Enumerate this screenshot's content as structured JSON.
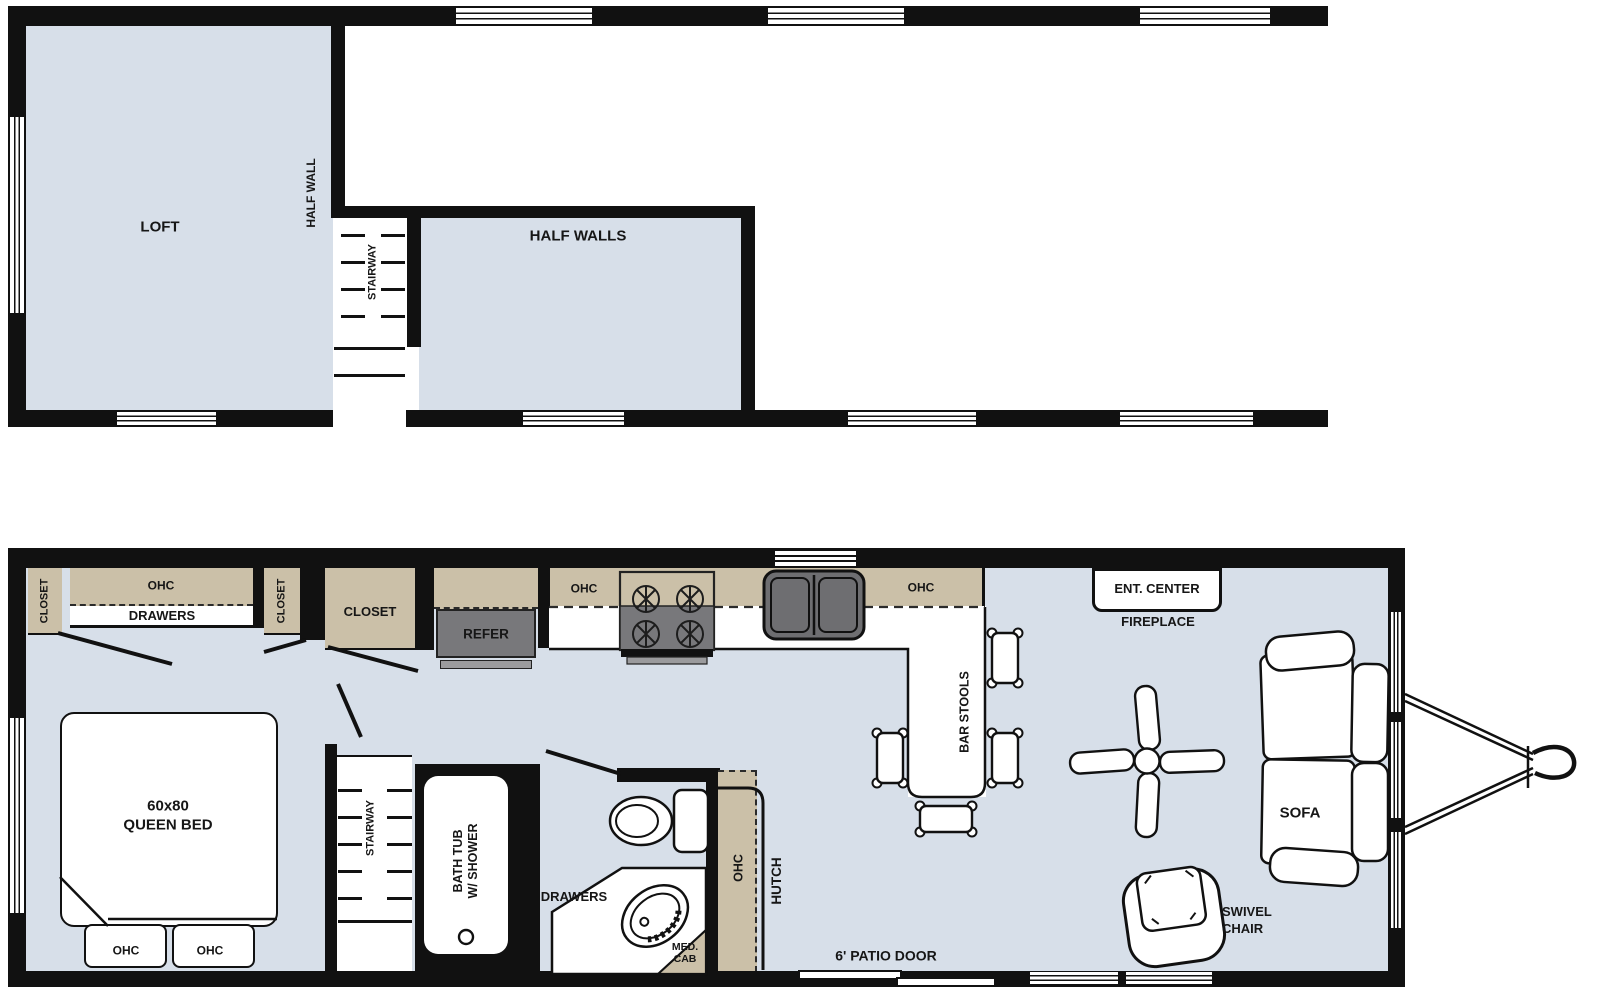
{
  "colors": {
    "wall": "#111111",
    "floor_blue": "#d7dfe9",
    "cabinet_tan": "#cbc0a8",
    "appliance_gray": "#78787b",
    "line": "#111111",
    "background": "#ffffff"
  },
  "upper": {
    "loft": "LOFT",
    "half_wall": "HALF WALL",
    "stairway": "STAIRWAY",
    "half_walls": "HALF WALLS"
  },
  "lower": {
    "closet_left": "CLOSET",
    "ohc_bed": "OHC",
    "drawers_bed": "DRAWERS",
    "closet_mid": "CLOSET",
    "closet_hall": "CLOSET",
    "refer": "REFER",
    "kitchen_ohc_left": "OHC",
    "kitchen_ohc_right": "OHC",
    "bar_stools": "BAR STOOLS",
    "ent_center": "ENT. CENTER",
    "fireplace": "FIREPLACE",
    "sofa": "SOFA",
    "swivel_line1": "SWIVEL",
    "swivel_line2": "CHAIR",
    "bed_line1": "60x80",
    "bed_line2": "QUEEN BED",
    "bed_ohc_left": "OHC",
    "bed_ohc_right": "OHC",
    "stairway": "STAIRWAY",
    "tub_line1": "BATH TUB",
    "tub_line2": "W/ SHOWER",
    "drawers_bath": "DRAWERS",
    "med_cab_line1": "MED.",
    "med_cab_line2": "CAB",
    "hutch_ohc": "OHC",
    "hutch": "HUTCH",
    "patio_door": "6' PATIO DOOR"
  }
}
